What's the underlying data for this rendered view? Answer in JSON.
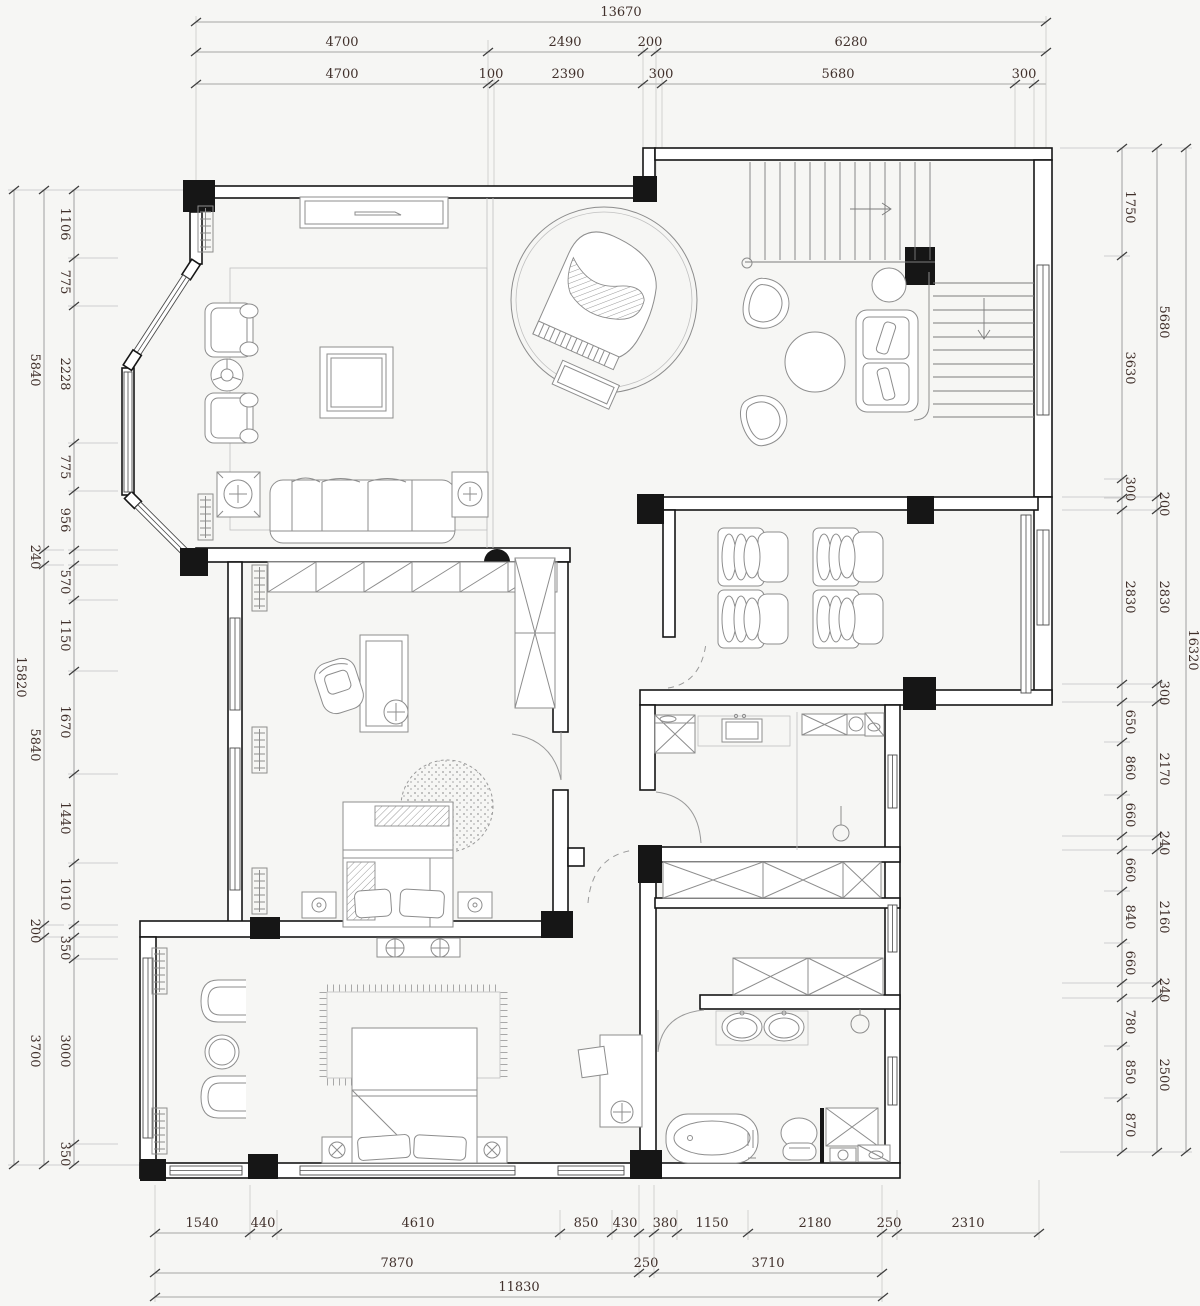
{
  "title": "residential-floor-plan",
  "colors": {
    "background": "#f6f6f4",
    "wall": "#161616",
    "column": "#161616",
    "furniture": "#8d8d8d",
    "dimension_line": "#8a8a8a",
    "dimension_text": "#40302b"
  },
  "dimensions": {
    "top": {
      "total": "13670",
      "row2": [
        "4700",
        "2490",
        "200",
        "6280"
      ],
      "row3": [
        "4700",
        "100",
        "2390",
        "300",
        "5680",
        "300"
      ]
    },
    "left": {
      "total": "15820",
      "mid": [
        "5840",
        "240",
        "5840",
        "200",
        "3700"
      ],
      "detail": [
        "1106",
        "775",
        "2228",
        "775",
        "956",
        "570",
        "1150",
        "1670",
        "1440",
        "1010",
        "350",
        "3000",
        "350"
      ]
    },
    "right": {
      "total": "16320",
      "mid": [
        "5680",
        "200",
        "2830",
        "300",
        "2170",
        "240",
        "2160",
        "240",
        "2500"
      ],
      "detail": [
        "1750",
        "3630",
        "300",
        "2830",
        "650",
        "860",
        "660",
        "660",
        "840",
        "660",
        "780",
        "850",
        "870"
      ]
    },
    "bottom": {
      "row1": [
        "1540",
        "440",
        "4610",
        "850",
        "430",
        "380",
        "1150",
        "2180",
        "250",
        "2310"
      ],
      "row2": [
        "7870",
        "250",
        "3710"
      ],
      "total": "11830"
    }
  }
}
